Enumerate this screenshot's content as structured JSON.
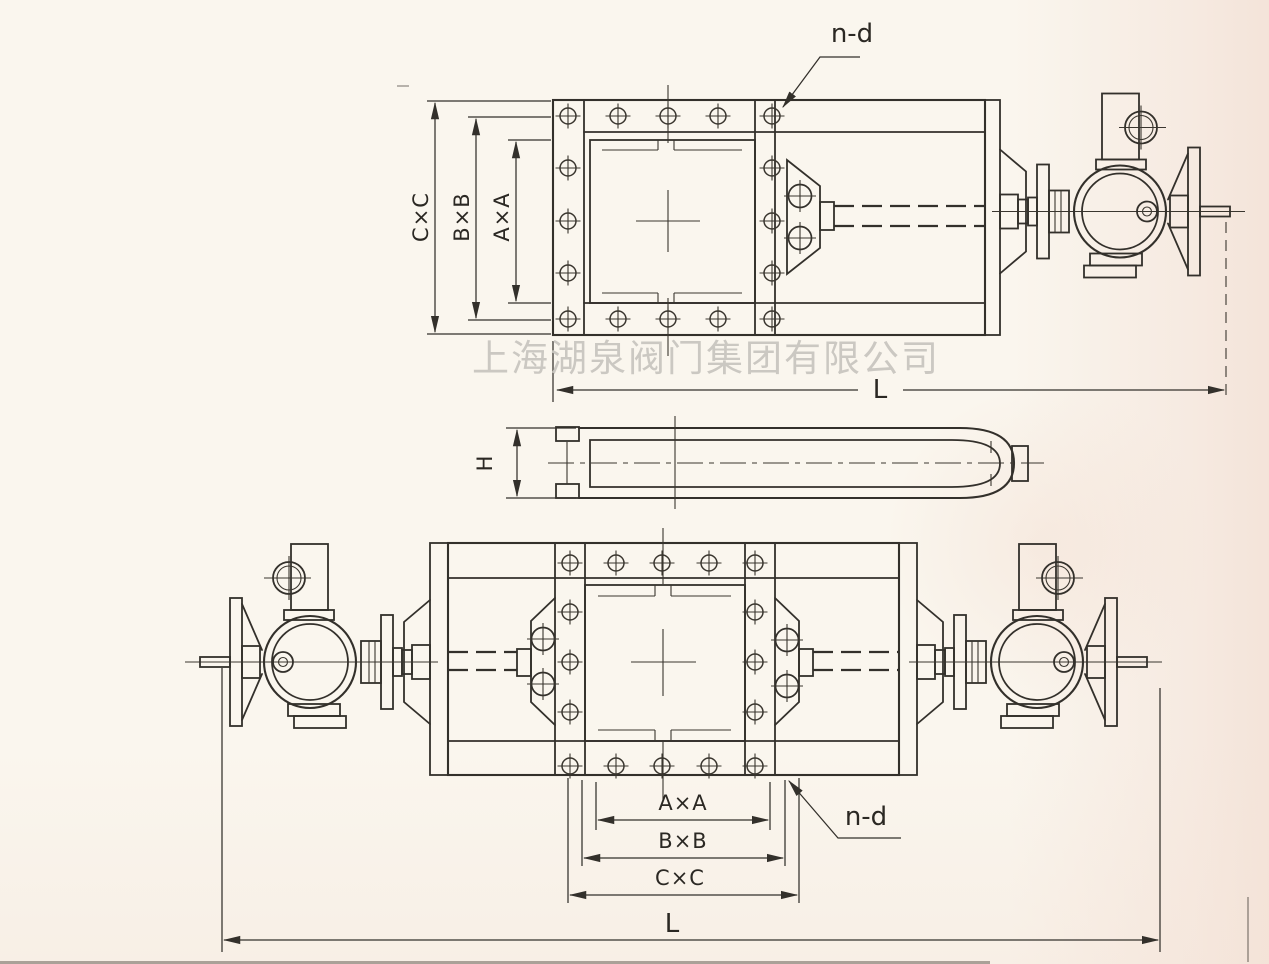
{
  "company_watermark": "上海湖泉阀门集团有限公司",
  "labels": {
    "top": {
      "nd": "n-d",
      "cc": "C×C",
      "bb": "B×B",
      "aa": "A×A",
      "length": "L"
    },
    "middle": {
      "height": "H"
    },
    "bottom": {
      "aa": "A×A",
      "bb": "B×B",
      "cc": "C×C",
      "nd": "n-d",
      "length": "L"
    }
  },
  "colors": {
    "paper": "#faf6ee",
    "line": "#33302b",
    "watermark": "#c9c6c0"
  }
}
